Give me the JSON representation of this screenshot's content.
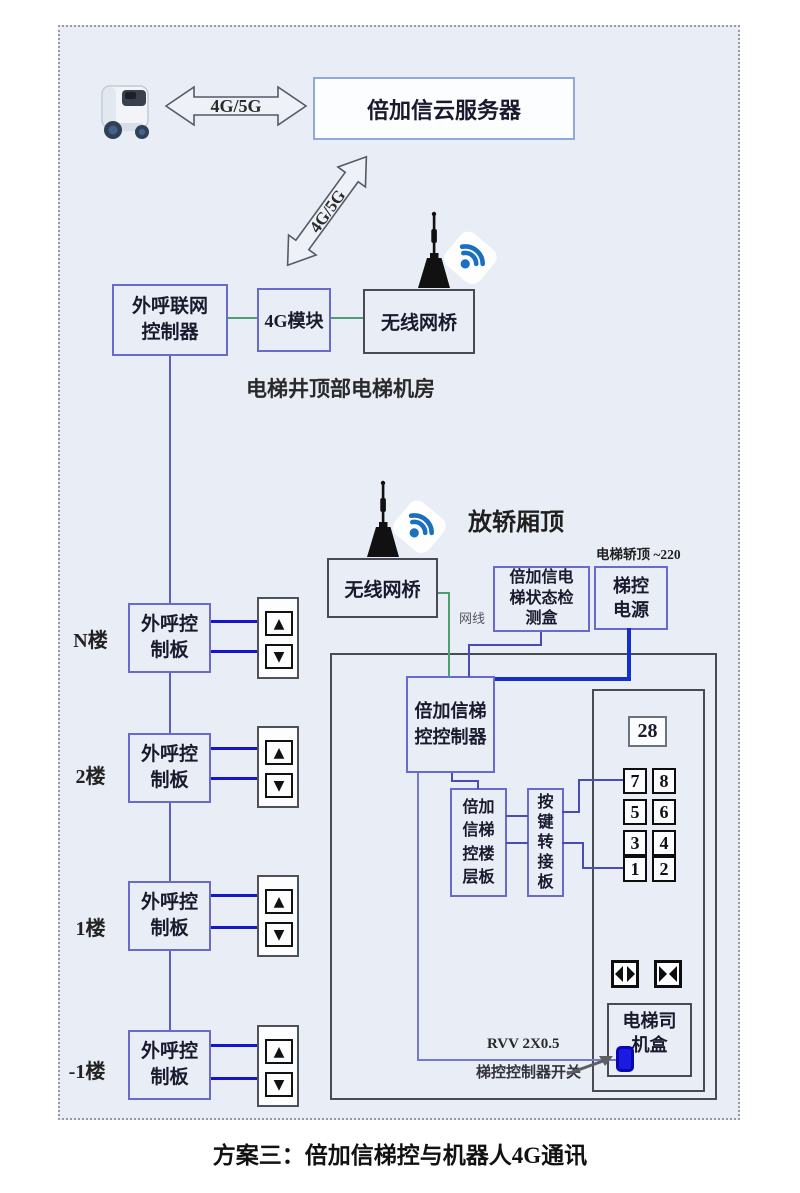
{
  "caption": "方案三：倍加信梯控与机器人4G通讯",
  "top": {
    "link_4g5g": "4G/5G",
    "diag_link_4g5g": "4G/5G",
    "cloud_server": "倍加信云服务器"
  },
  "machine_room": {
    "room_caption": "电梯井顶部电梯机房",
    "outcall_controller": {
      "line1": "外呼联网",
      "line2": "控制器"
    },
    "module_4g": "4G模块",
    "wireless_bridge": "无线网桥"
  },
  "car_top": {
    "caption": "放轿厢顶",
    "wireless_bridge": "无线网桥",
    "status_box": {
      "line1": "倍加信电",
      "line2": "梯状态检",
      "line3": "测盒"
    },
    "power_note": "电梯轿顶 ~220",
    "power_box": {
      "line1": "梯控",
      "line2": "电源"
    },
    "net_cable_label": "网线"
  },
  "floors": [
    {
      "label": "N楼"
    },
    {
      "label": "2楼"
    },
    {
      "label": "1楼"
    },
    {
      "label": "-1楼"
    }
  ],
  "outcall_board": {
    "line1": "外呼控",
    "line2": "制板"
  },
  "icons": {
    "up": "▲",
    "down": "▼"
  },
  "cabinet": {
    "controller": {
      "line1": "倍加信梯",
      "line2": "控控制器"
    },
    "floor_board": {
      "line1": "倍加",
      "line2": "信梯",
      "line3": "控楼",
      "line4": "层板"
    },
    "key_adapter": {
      "line1": "按",
      "line2": "键",
      "line3": "转",
      "line4": "接",
      "line5": "板"
    },
    "display_value": "28",
    "floor_buttons": [
      [
        "7",
        "8"
      ],
      [
        "5",
        "6"
      ],
      [
        "3",
        "4"
      ],
      [
        "1",
        "2"
      ]
    ],
    "driver_box": {
      "line1": "电梯司",
      "line2": "机盒"
    },
    "rvv_label": "RVV 2X0.5",
    "switch_label": "梯控控制器开关"
  },
  "colors": {
    "board_bg": "#e9edf6",
    "blue_box_border": "#6a6ace",
    "gray_box_border": "#4a4a52",
    "cloud_border": "#8fa9d9",
    "wire_blue": "#4a4ab8",
    "wire_green": "#4f9e72",
    "wire_call_blue": "#1515cc",
    "wire_power_blue": "#1330cc",
    "wifi_blue": "#1a6fc0"
  }
}
